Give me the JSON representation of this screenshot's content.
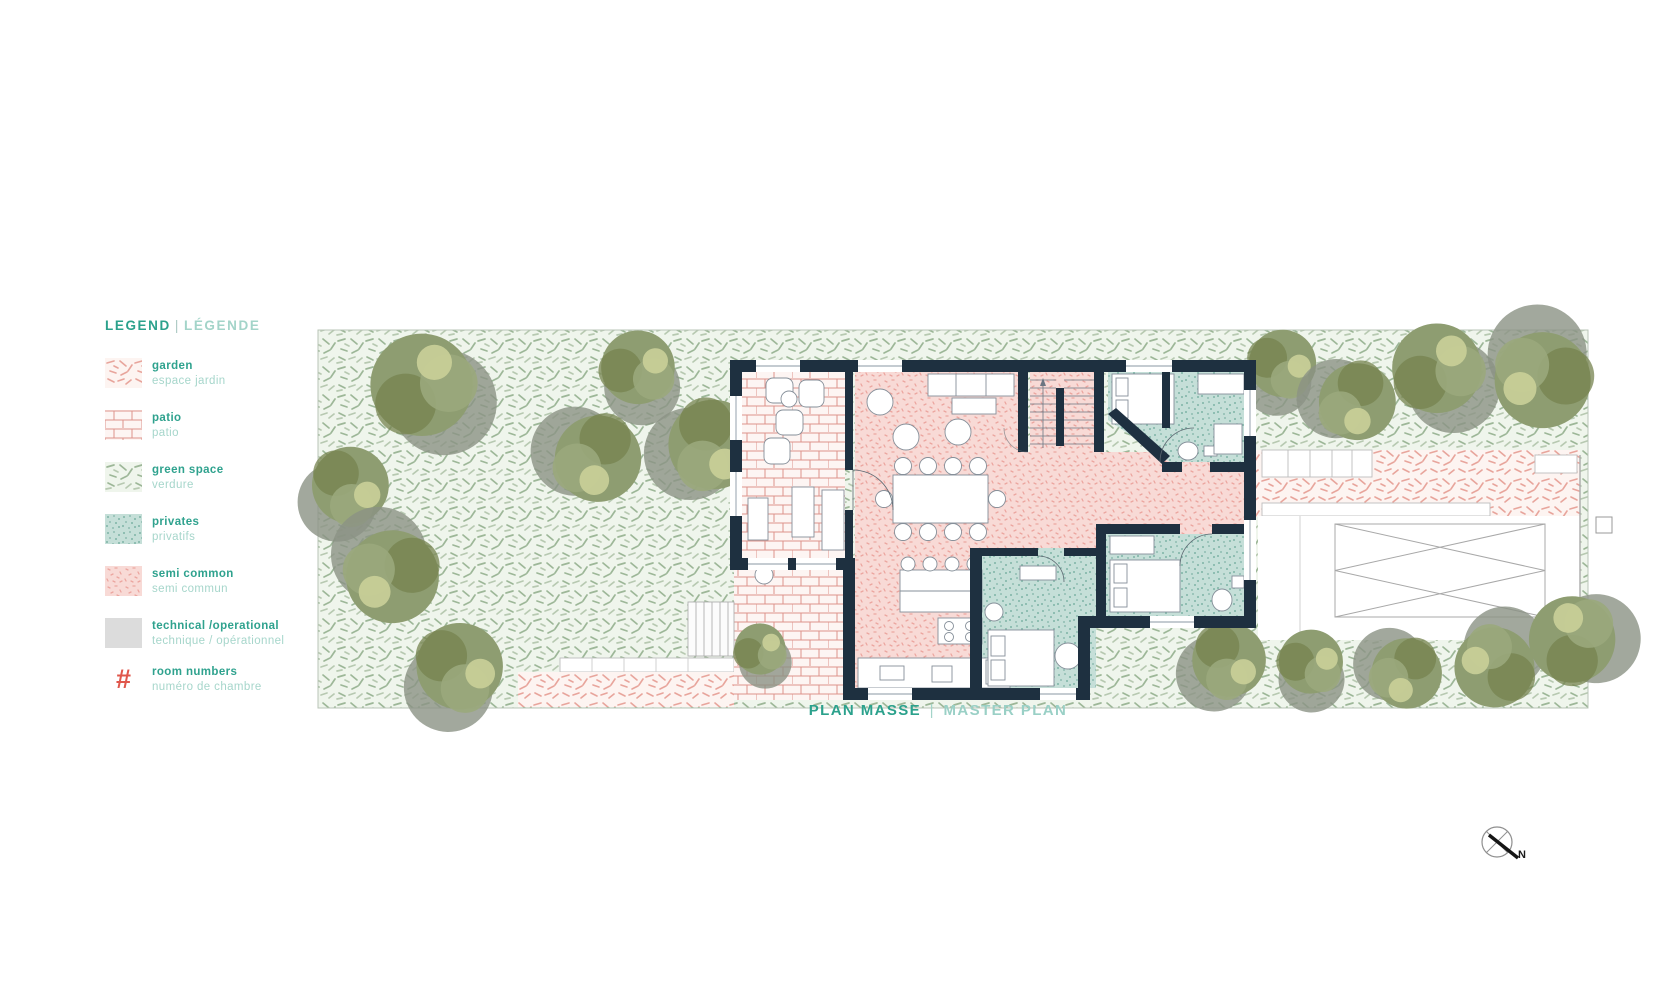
{
  "legend": {
    "title_en": "LEGEND",
    "title_sep": "|",
    "title_fr": "LÉGENDE",
    "items": [
      {
        "key": "garden",
        "swatch": "garden-hatch-swatch-icon",
        "label_en": "garden",
        "label_fr": "espace jardin"
      },
      {
        "key": "patio",
        "swatch": "brick-swatch-icon",
        "label_en": "patio",
        "label_fr": "patio"
      },
      {
        "key": "green-space",
        "swatch": "green-hatch-swatch-icon",
        "label_en": "green space",
        "label_fr": "verdure"
      },
      {
        "key": "privates",
        "swatch": "teal-speckle-swatch-icon",
        "label_en": "privates",
        "label_fr": "privatifs"
      },
      {
        "key": "semi-common",
        "swatch": "pink-speckle-swatch-icon",
        "label_en": "semi common",
        "label_fr": "semi commun"
      },
      {
        "key": "technical",
        "swatch": "gray-swatch-icon",
        "label_en": "technical /operational",
        "label_fr": "technique / opérationnel"
      },
      {
        "key": "room-numbers",
        "swatch": "hash-icon",
        "label_en": "room numbers",
        "label_fr": "numéro de chambre"
      }
    ],
    "hash_symbol": "#"
  },
  "caption": {
    "fr": "PLAN MASSE",
    "sep": "|",
    "en": "MASTER PLAN"
  },
  "compass": {
    "label": "N"
  },
  "colors": {
    "teal_text": "#2ba18c",
    "teal_text_light": "#a3d4c9",
    "coral": "#e0574c",
    "wall_navy": "#1e3040",
    "semi_common_pink": "#f8dad6",
    "privates_teal": "#c5dfd8",
    "green_space": "#eff5ec",
    "technical_gray": "#dcdcdc"
  }
}
